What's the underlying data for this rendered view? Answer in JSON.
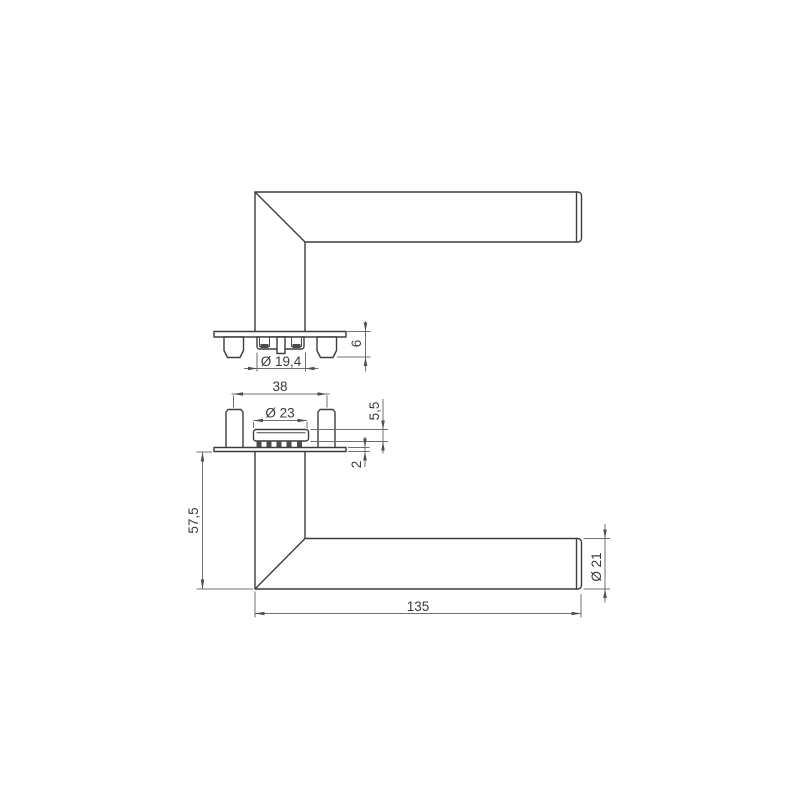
{
  "drawing": {
    "dimensions": {
      "rose_diameter": "Ø 19,4",
      "rose_height": "6",
      "pin_spacing": "38",
      "hub_diameter": "Ø 23",
      "hub_height": "5,5",
      "plate_thickness": "2",
      "handle_projection": "57,5",
      "lever_length": "135",
      "lever_diameter": "Ø 21"
    },
    "colors": {
      "object_line": "#3d3d3d",
      "dimension_line": "#6f6f6f",
      "text": "#3a3a3a",
      "background": "#ffffff"
    }
  }
}
